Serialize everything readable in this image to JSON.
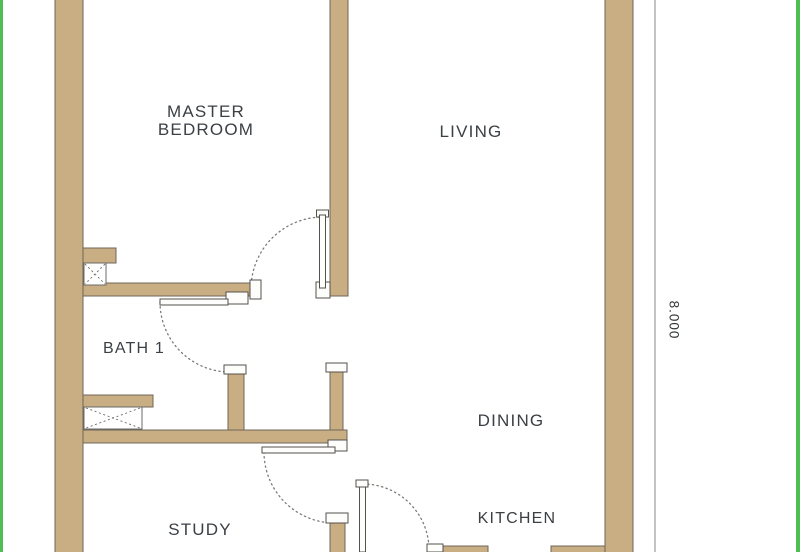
{
  "plan": {
    "title": "apartment-floor-plan",
    "rooms": [
      {
        "id": "master-bedroom",
        "label": "MASTER BEDROOM"
      },
      {
        "id": "living",
        "label": "LIVING"
      },
      {
        "id": "bath-1",
        "label": "BATH 1"
      },
      {
        "id": "dining",
        "label": "DINING"
      },
      {
        "id": "study",
        "label": "STUDY"
      },
      {
        "id": "kitchen",
        "label": "KITCHEN"
      }
    ],
    "dimension": {
      "value": "8.000"
    },
    "colors": {
      "wall_fill": "#C9AD83",
      "wall_outline": "#6F675A",
      "border_green": "#4FBE53",
      "door_fill": "#FDFDFB",
      "door_outline": "#55514B",
      "swing_dash": "#7A7A76",
      "dim_line": "#9B9B97",
      "text": "#3B4045"
    }
  }
}
